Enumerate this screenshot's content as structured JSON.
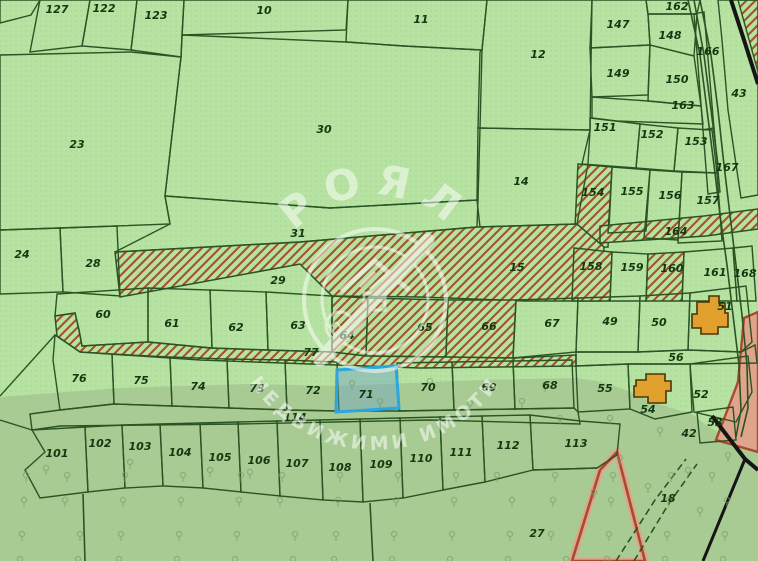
{
  "map": {
    "width": 758,
    "height": 561,
    "watermark": {
      "brand": "РОЯЛ",
      "tagline": "НЕДВИЖИМИ ИМОТИ"
    },
    "selected_parcel_id": "71",
    "colors": {
      "light_green": "#b6e2a2",
      "forest_green": "#a8cb93",
      "border": "#2a5424",
      "hatch_red": "#a5522c",
      "label": "#14380f",
      "selected_stroke": "#2aa7e0",
      "selected_fill": "#6ea0c8",
      "building": "#e1a02e",
      "building_border": "#4a3505",
      "road_salmon_fill": "#dfa58c",
      "road_salmon_edge": "#a84a2e",
      "black_line": "#151515",
      "tree": "#76a066",
      "dot_texture": "#78a868",
      "watermark_white": "#ffffff"
    },
    "parcels": [
      {
        "id": "",
        "t": "p",
        "pts": "0,0 40,0 31,15 0,23",
        "lx": 0,
        "ly": 0
      },
      {
        "id": "127",
        "t": "p",
        "pts": "40,0 90,0 82,46 30,52",
        "lx": 57,
        "ly": 13
      },
      {
        "id": "122",
        "t": "p",
        "pts": "90,0 137,0 131,50 82,46",
        "lx": 104,
        "ly": 12
      },
      {
        "id": "123",
        "t": "p",
        "pts": "137,0 184,0 181,57 131,50",
        "lx": 156,
        "ly": 19
      },
      {
        "id": "10",
        "t": "p",
        "pts": "184,0 348,0 346,30 182,35",
        "lx": 264,
        "ly": 14
      },
      {
        "id": "11",
        "t": "p",
        "pts": "348,0 487,0 482,50 404,46 346,42",
        "lx": 421,
        "ly": 23
      },
      {
        "id": "12",
        "t": "p",
        "pts": "487,0 592,0 590,130 478,128 480,52 482,50",
        "lx": 538,
        "ly": 58
      },
      {
        "id": "23",
        "t": "p",
        "pts": "0,55 131,52 181,57 165,196 170,224 60,228 0,230",
        "lx": 77,
        "ly": 148
      },
      {
        "id": "30",
        "t": "p",
        "pts": "182,35 346,42 404,46 482,50 480,128 478,200 330,208 165,196 181,57",
        "lx": 324,
        "ly": 133
      },
      {
        "id": "147",
        "t": "p",
        "pts": "592,0 646,0 648,14 650,45 590,48",
        "lx": 618,
        "ly": 28
      },
      {
        "id": "162",
        "t": "p",
        "pts": "646,0 700,0 697,14 648,14",
        "lx": 677,
        "ly": 10
      },
      {
        "id": "148",
        "t": "p",
        "pts": "648,14 697,14 694,56 650,45",
        "lx": 670,
        "ly": 39
      },
      {
        "id": "166",
        "t": "p",
        "pts": "694,14 704,12 714,128 703,130",
        "lx": 708,
        "ly": 55
      },
      {
        "id": "149",
        "t": "p",
        "pts": "590,48 650,45 648,95 592,97",
        "lx": 618,
        "ly": 77
      },
      {
        "id": "150",
        "t": "p",
        "pts": "650,45 694,56 701,106 648,101",
        "lx": 677,
        "ly": 83
      },
      {
        "id": "163",
        "t": "p",
        "pts": "592,97 648,101 701,106 703,124 616,121 592,118",
        "lx": 683,
        "ly": 109
      },
      {
        "id": "43",
        "t": "p",
        "pts": "718,0 758,0 758,195 741,198 728,110 722,40",
        "lx": 739,
        "ly": 97
      },
      {
        "id": "151",
        "t": "p",
        "pts": "590,118 616,121 640,124 636,168 582,164 590,130",
        "lx": 605,
        "ly": 131
      },
      {
        "id": "152",
        "t": "p",
        "pts": "640,124 678,128 674,171 636,168",
        "lx": 652,
        "ly": 138
      },
      {
        "id": "153",
        "t": "p",
        "pts": "678,128 712,130 717,173 674,171",
        "lx": 696,
        "ly": 145
      },
      {
        "id": "167",
        "t": "p",
        "pts": "703,130 714,128 720,192 708,194",
        "lx": 727,
        "ly": 171
      },
      {
        "id": "154",
        "t": "h",
        "pts": "578,164 612,167 608,247 574,248",
        "lx": 593,
        "ly": 196
      },
      {
        "id": "155",
        "t": "p",
        "pts": "612,167 650,170 646,231 608,233",
        "lx": 632,
        "ly": 195
      },
      {
        "id": "156",
        "t": "p",
        "pts": "650,170 682,172 678,240 644,238",
        "lx": 670,
        "ly": 199
      },
      {
        "id": "157",
        "t": "p",
        "pts": "682,172 717,173 722,241 678,243",
        "lx": 708,
        "ly": 204
      },
      {
        "id": "164",
        "t": "h",
        "pts": "600,226 704,216 758,209 758,229 706,236 600,243",
        "lx": 676,
        "ly": 235
      },
      {
        "id": "24",
        "t": "p",
        "pts": "0,230 60,228 63,292 0,294",
        "lx": 22,
        "ly": 258
      },
      {
        "id": "28",
        "t": "p",
        "pts": "60,228 117,226 120,296 63,292",
        "lx": 93,
        "ly": 267
      },
      {
        "id": "31",
        "t": "p",
        "pts": "165,196 330,208 478,200 477,227 300,242 115,252 170,224",
        "lx": 298,
        "ly": 237
      },
      {
        "id": "14",
        "t": "p",
        "pts": "478,128 590,130 588,164 577,224 480,227 477,200",
        "lx": 521,
        "ly": 185
      },
      {
        "id": "29",
        "t": "h",
        "pts": "115,252 300,242 477,227 577,224 604,247 602,301 524,301 420,297 332,296 300,264 120,297",
        "lx": 278,
        "ly": 284
      },
      {
        "id": "15",
        "t": "lbl",
        "pts": "",
        "lx": 517,
        "ly": 271
      },
      {
        "id": "158",
        "t": "h",
        "pts": "574,248 612,252 610,301 572,301",
        "lx": 591,
        "ly": 270
      },
      {
        "id": "159",
        "t": "p",
        "pts": "612,252 648,254 646,301 610,301",
        "lx": 632,
        "ly": 271
      },
      {
        "id": "160",
        "t": "h",
        "pts": "648,254 684,252 682,301 646,301",
        "lx": 672,
        "ly": 272
      },
      {
        "id": "161",
        "t": "p",
        "pts": "684,252 733,248 737,301 682,301",
        "lx": 715,
        "ly": 276
      },
      {
        "id": "168",
        "t": "p",
        "pts": "733,248 752,246 756,301 737,301",
        "lx": 745,
        "ly": 277
      },
      {
        "id": "60",
        "t": "p",
        "pts": "57,294 148,288 148,342 82,346 79,330 75,313 55,316",
        "lx": 103,
        "ly": 318
      },
      {
        "id": "61",
        "t": "p",
        "pts": "148,288 210,290 212,348 148,342",
        "lx": 172,
        "ly": 327
      },
      {
        "id": "62",
        "t": "p",
        "pts": "210,290 266,292 268,350 212,348",
        "lx": 236,
        "ly": 331
      },
      {
        "id": "63",
        "t": "p",
        "pts": "266,292 332,296 332,352 268,350",
        "lx": 298,
        "ly": 329
      },
      {
        "id": "64",
        "t": "h",
        "pts": "332,296 368,298 366,356 332,352",
        "lx": 347,
        "ly": 339
      },
      {
        "id": "65",
        "t": "h",
        "pts": "368,298 448,300 446,357 366,356",
        "lx": 425,
        "ly": 331
      },
      {
        "id": "66",
        "t": "h",
        "pts": "448,300 516,300 513,358 446,357",
        "lx": 489,
        "ly": 330
      },
      {
        "id": "77",
        "t": "h",
        "pts": "55,316 75,313 79,330 82,346 148,342 210,348 266,350 332,352 366,356 446,357 513,358 576,355 576,366 420,368 200,360 80,352 57,336",
        "lx": 311,
        "ly": 356
      },
      {
        "id": "67",
        "t": "p",
        "pts": "516,300 578,298 576,352 513,358",
        "lx": 552,
        "ly": 327
      },
      {
        "id": "49",
        "t": "p",
        "pts": "578,298 640,296 638,352 576,352",
        "lx": 610,
        "ly": 325
      },
      {
        "id": "50",
        "t": "p",
        "pts": "640,296 690,293 688,350 638,352",
        "lx": 659,
        "ly": 326
      },
      {
        "id": "51",
        "t": "p",
        "pts": "690,293 746,286 752,342 741,352 688,350",
        "lx": 725,
        "ly": 310
      },
      {
        "id": "56",
        "t": "p",
        "pts": "576,352 638,352 688,350 741,352 755,345 757,363 690,364 628,364 576,366",
        "lx": 676,
        "ly": 361
      },
      {
        "id": "76",
        "t": "p",
        "pts": "55,335 80,352 112,354 114,404 60,410 53,360",
        "lx": 79,
        "ly": 382
      },
      {
        "id": "75",
        "t": "p",
        "pts": "112,354 170,357 172,406 114,404",
        "lx": 141,
        "ly": 384
      },
      {
        "id": "74",
        "t": "p",
        "pts": "170,357 227,359 229,408 172,406",
        "lx": 198,
        "ly": 390
      },
      {
        "id": "73",
        "t": "p",
        "pts": "227,359 285,360 287,410 229,408",
        "lx": 257,
        "ly": 392
      },
      {
        "id": "72",
        "t": "p",
        "pts": "285,360 337,362 339,411 287,410",
        "lx": 313,
        "ly": 394
      },
      {
        "id": "71",
        "t": "s",
        "pts": "337,370 396,366 399,408 336,412",
        "lx": 366,
        "ly": 398
      },
      {
        "id": "70",
        "t": "p",
        "pts": "397,363 452,362 454,410 399,411",
        "lx": 428,
        "ly": 391
      },
      {
        "id": "69",
        "t": "p",
        "pts": "452,362 513,361 515,409 454,410",
        "lx": 489,
        "ly": 391
      },
      {
        "id": "68",
        "t": "p",
        "pts": "513,361 572,360 574,408 515,409",
        "lx": 550,
        "ly": 389
      },
      {
        "id": "55",
        "t": "p",
        "pts": "576,366 628,364 630,409 578,412",
        "lx": 605,
        "ly": 392
      },
      {
        "id": "54",
        "t": "p",
        "pts": "628,364 690,364 692,412 655,419 630,409",
        "lx": 648,
        "ly": 413
      },
      {
        "id": "52",
        "t": "p",
        "pts": "690,364 748,356 752,392 736,422 694,412",
        "lx": 701,
        "ly": 398
      },
      {
        "id": "53",
        "t": "p",
        "pts": "697,412 733,407 736,440 700,443",
        "lx": 715,
        "ly": 426
      },
      {
        "id": "42",
        "t": "lbl",
        "pts": "",
        "lx": 689,
        "ly": 437
      },
      {
        "id": "114",
        "t": "p",
        "pts": "30,414 60,410 114,404 172,406 229,408 287,410 339,411 399,411 454,410 515,409 574,408 578,412 580,424 430,420 240,424 60,426 32,430",
        "lx": 295,
        "ly": 421
      },
      {
        "id": "101",
        "t": "p",
        "pts": "32,430 85,427 88,492 40,498 25,470 45,452",
        "lx": 57,
        "ly": 457
      },
      {
        "id": "102",
        "t": "p",
        "pts": "85,427 122,425 125,488 88,492",
        "lx": 100,
        "ly": 447
      },
      {
        "id": "103",
        "t": "p",
        "pts": "122,425 160,424 163,486 125,488",
        "lx": 140,
        "ly": 450
      },
      {
        "id": "104",
        "t": "p",
        "pts": "160,424 200,423 203,488 163,486",
        "lx": 180,
        "ly": 456
      },
      {
        "id": "105",
        "t": "p",
        "pts": "200,423 238,422 241,492 203,488",
        "lx": 220,
        "ly": 461
      },
      {
        "id": "106",
        "t": "p",
        "pts": "238,422 277,421 280,496 241,492",
        "lx": 259,
        "ly": 464
      },
      {
        "id": "107",
        "t": "p",
        "pts": "277,421 320,420 323,500 280,496",
        "lx": 297,
        "ly": 467
      },
      {
        "id": "108",
        "t": "p",
        "pts": "320,420 360,419 363,502 323,500",
        "lx": 340,
        "ly": 471
      },
      {
        "id": "109",
        "t": "p",
        "pts": "360,419 400,418 403,498 363,502",
        "lx": 381,
        "ly": 468
      },
      {
        "id": "110",
        "t": "p",
        "pts": "400,418 440,417 443,490 403,498",
        "lx": 421,
        "ly": 462
      },
      {
        "id": "111",
        "t": "p",
        "pts": "440,417 482,416 485,482 443,490",
        "lx": 461,
        "ly": 456
      },
      {
        "id": "112",
        "t": "p",
        "pts": "482,416 530,415 533,470 485,482",
        "lx": 508,
        "ly": 449
      },
      {
        "id": "113",
        "t": "p",
        "pts": "530,415 580,421 620,424 617,455 597,468 533,470",
        "lx": 576,
        "ly": 447
      },
      {
        "id": "27",
        "t": "lbl",
        "pts": "",
        "lx": 537,
        "ly": 537
      },
      {
        "id": "18",
        "t": "lbl",
        "pts": "",
        "lx": 668,
        "ly": 502
      }
    ],
    "lines": [
      {
        "pts": "0,396 55,335",
        "w": 1.4
      },
      {
        "pts": "0,420 32,430",
        "w": 1.4
      },
      {
        "pts": "83,494 85,561",
        "w": 1.6
      },
      {
        "pts": "370,503 373,561",
        "w": 1.6
      },
      {
        "pts": "597,468 533,470",
        "w": 1.6
      }
    ],
    "roads": [
      {
        "pts": "688,0 700,55 707,110 714,165 720,215 727,265 733,315 739,365 741,410 736,437",
        "dash": false
      },
      {
        "pts": "700,0 711,55 718,110 724,165 730,215 736,265 742,315 747,365 748,408 741,437",
        "dash": false
      },
      {
        "pts": "694,0 704,55 711,110 718,165",
        "dash": false
      },
      {
        "pts": "616,561 655,500 686,459",
        "dash": true
      },
      {
        "pts": "634,561 668,505 697,464",
        "dash": true
      }
    ],
    "black_lines": [
      {
        "pts": "731,0 744,40 758,84",
        "w": 4
      },
      {
        "pts": "712,416 745,459 758,470",
        "w": 4
      },
      {
        "pts": "745,459 703,561",
        "w": 3
      }
    ],
    "red_roads": {
      "band_pts": "744,318 758,312 758,452 716,440 738,382",
      "wedge_pts": "600,470 617,452 645,561 572,561 600,470",
      "corner_hatch_pts": "738,0 758,0 758,72"
    },
    "buildings": [
      {
        "id": "building-51",
        "pts": "697,302 709,302 709,296 719,296 719,303 725,303 725,313 728,313 728,327 718,327 718,334 701,334 701,328 692,328 692,314 697,314"
      },
      {
        "id": "building-54",
        "pts": "636,380 646,380 646,374 665,374 665,381 671,381 671,391 666,391 666,403 648,403 648,397 634,397 634,386 636,386"
      }
    ],
    "forest_pts": "0,397 120,388 250,384 340,386 480,380 576,378 602,382 626,390 652,402 678,410 692,414 702,422 714,430 726,435 740,440 758,449 758,561 0,561"
  }
}
